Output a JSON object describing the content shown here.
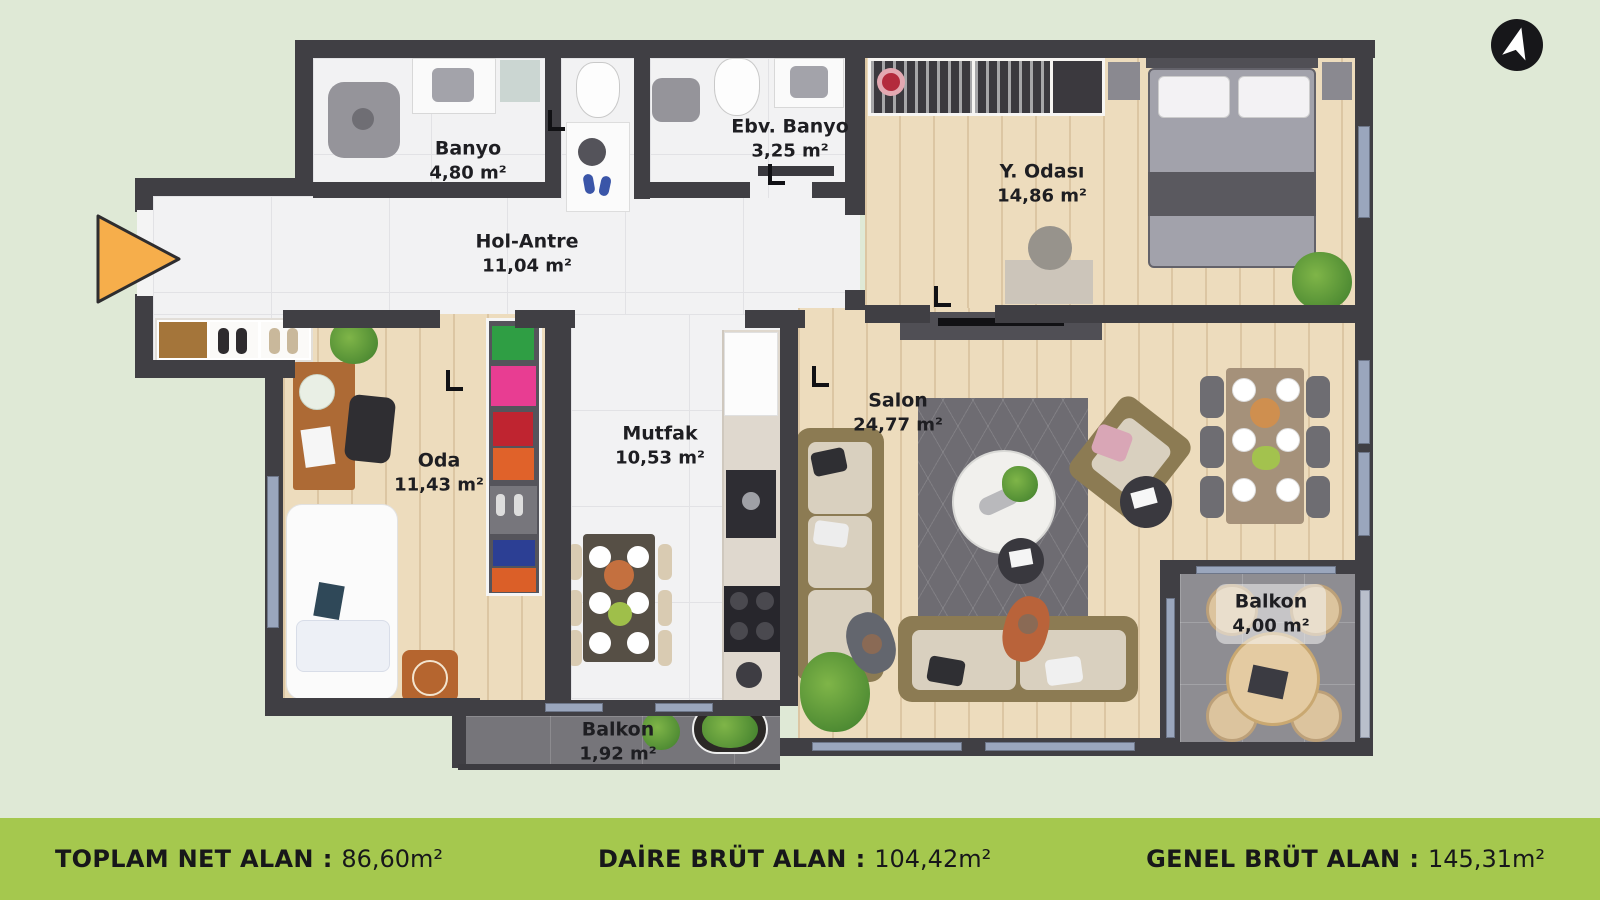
{
  "rooms": [
    {
      "id": "banyo",
      "name": "Banyo",
      "area": "4,80 m²"
    },
    {
      "id": "ebv-banyo",
      "name": "Ebv. Banyo",
      "area": "3,25 m²"
    },
    {
      "id": "y-odasi",
      "name": "Y. Odası",
      "area": "14,86 m²"
    },
    {
      "id": "hol-antre",
      "name": "Hol-Antre",
      "area": "11,04 m²"
    },
    {
      "id": "oda",
      "name": "Oda",
      "area": "11,43 m²"
    },
    {
      "id": "mutfak",
      "name": "Mutfak",
      "area": "10,53 m²"
    },
    {
      "id": "salon",
      "name": "Salon",
      "area": "24,77 m²"
    },
    {
      "id": "balkon-kucuk",
      "name": "Balkon",
      "area": "1,92 m²"
    },
    {
      "id": "balkon-buyuk",
      "name": "Balkon",
      "area": "4,00 m²"
    }
  ],
  "footer": {
    "separator": ":",
    "items": [
      {
        "label": "TOPLAM NET ALAN",
        "value": "86,60m²"
      },
      {
        "label": "DAİRE BRÜT ALAN",
        "value": "104,42m²"
      },
      {
        "label": "GENEL BRÜT ALAN",
        "value": "145,31m²"
      }
    ]
  },
  "icons": {
    "north": "north-arrow",
    "entrance": "entrance-direction-arrow"
  },
  "colors": {
    "background": "#DFE9D6",
    "footer_bar": "#A5C84E",
    "wall": "#403F44",
    "wood_floor": "#EDDCBD",
    "tile_floor": "#F2F2F3",
    "balcony_floor": "#76757A",
    "window": "#9AA6BD",
    "entrance_arrow": "#F6AE4B"
  }
}
